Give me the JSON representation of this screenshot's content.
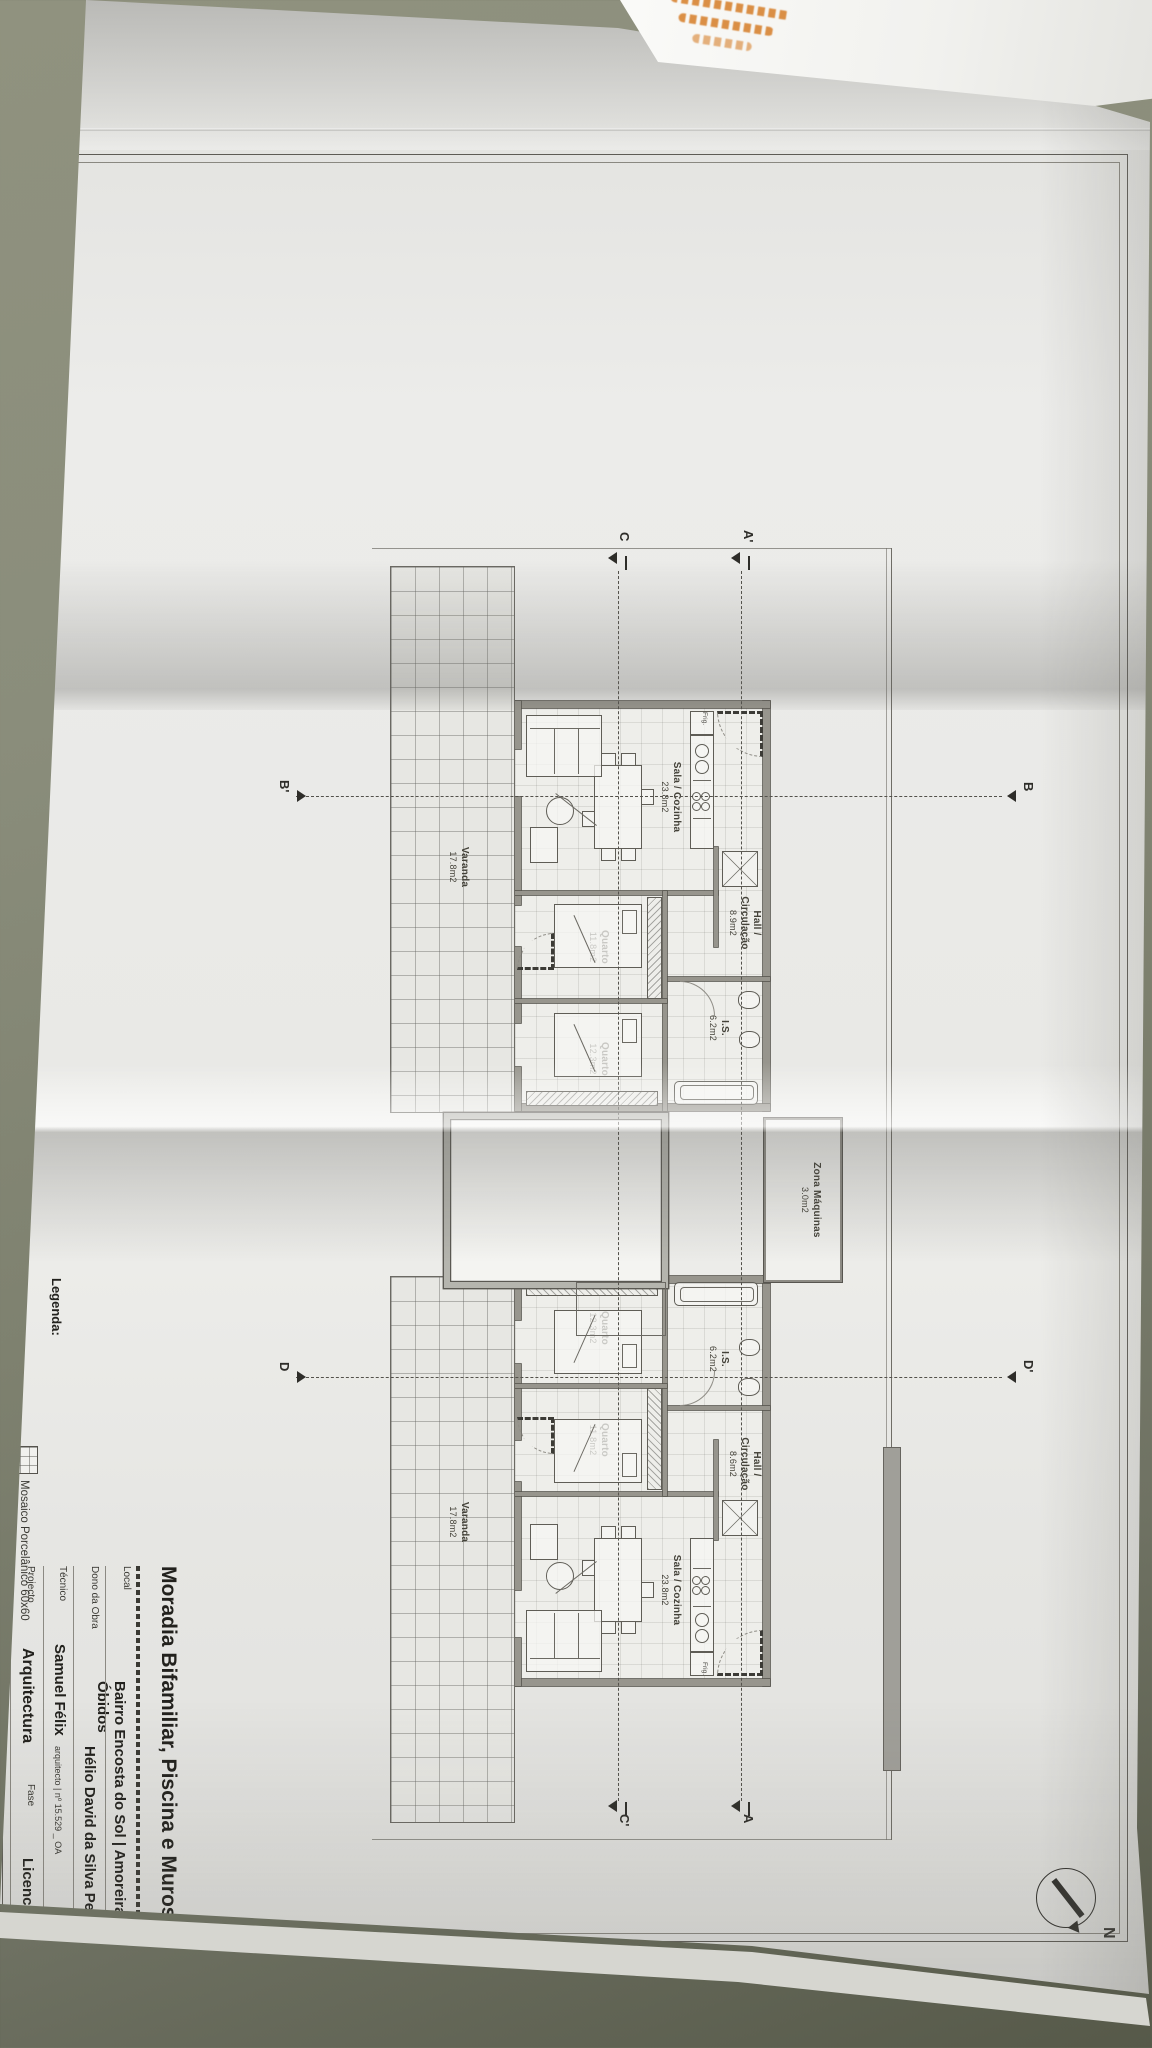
{
  "sheet": {
    "title_block": {
      "title": "Moradia Bifamiliar, Piscina e Muros",
      "local_label": "Local",
      "local_value": "Bairro Encosta do Sol | Amoreira | Óbidos",
      "owner_label": "Dono da Obra",
      "owner_value": "Hélio David da Silva Penteado",
      "technician_label": "Técnico",
      "technician_value": "Samuel Félix",
      "technician_suffix": "arquitecto | nº 15.529 _ OA",
      "project_label": "Projecto",
      "project_value": "Arquitectura",
      "phase_label": "Fase",
      "phase_value": "Licenciamento"
    },
    "legend": {
      "label": "Legenda:",
      "item_1": "Mosaico Porcelânico 60x60"
    },
    "north_label": "N",
    "sections": {
      "a_start": "A'",
      "a_end": "A",
      "b_start": "B",
      "b_end": "B'",
      "c_start": "C",
      "c_end": "C'",
      "d_start": "D'",
      "d_end": "D"
    },
    "zona": {
      "name": "Zona Máquinas",
      "area": "3.0m2"
    },
    "units": [
      {
        "sala": {
          "name": "Sala / Cozinha",
          "area": "23.8m2"
        },
        "hall": {
          "line1": "Hall /",
          "line2": "Circulação",
          "area": "8.9m2"
        },
        "is": {
          "name": "I.S.",
          "area": "6.2m2"
        },
        "quarto1": {
          "name": "Quarto",
          "area": "11.8m2"
        },
        "quarto2": {
          "name": "Quarto",
          "area": "12.3m2"
        },
        "varanda": {
          "name": "Varanda",
          "area": "17.8m2"
        },
        "fridge_label": "Frig."
      },
      {
        "sala": {
          "name": "Sala / Cozinha",
          "area": "23.8m2"
        },
        "hall": {
          "line1": "Hall /",
          "line2": "Circulação",
          "area": "8.6m2"
        },
        "is": {
          "name": "I.S.",
          "area": "6.2m2"
        },
        "quarto1": {
          "name": "Quarto",
          "area": "11.8m2"
        },
        "quarto2": {
          "name": "Quarto",
          "area": "12.3m2"
        },
        "varanda": {
          "name": "Varanda",
          "area": "17.8m2"
        },
        "fridge_label": "Frig."
      }
    ]
  }
}
